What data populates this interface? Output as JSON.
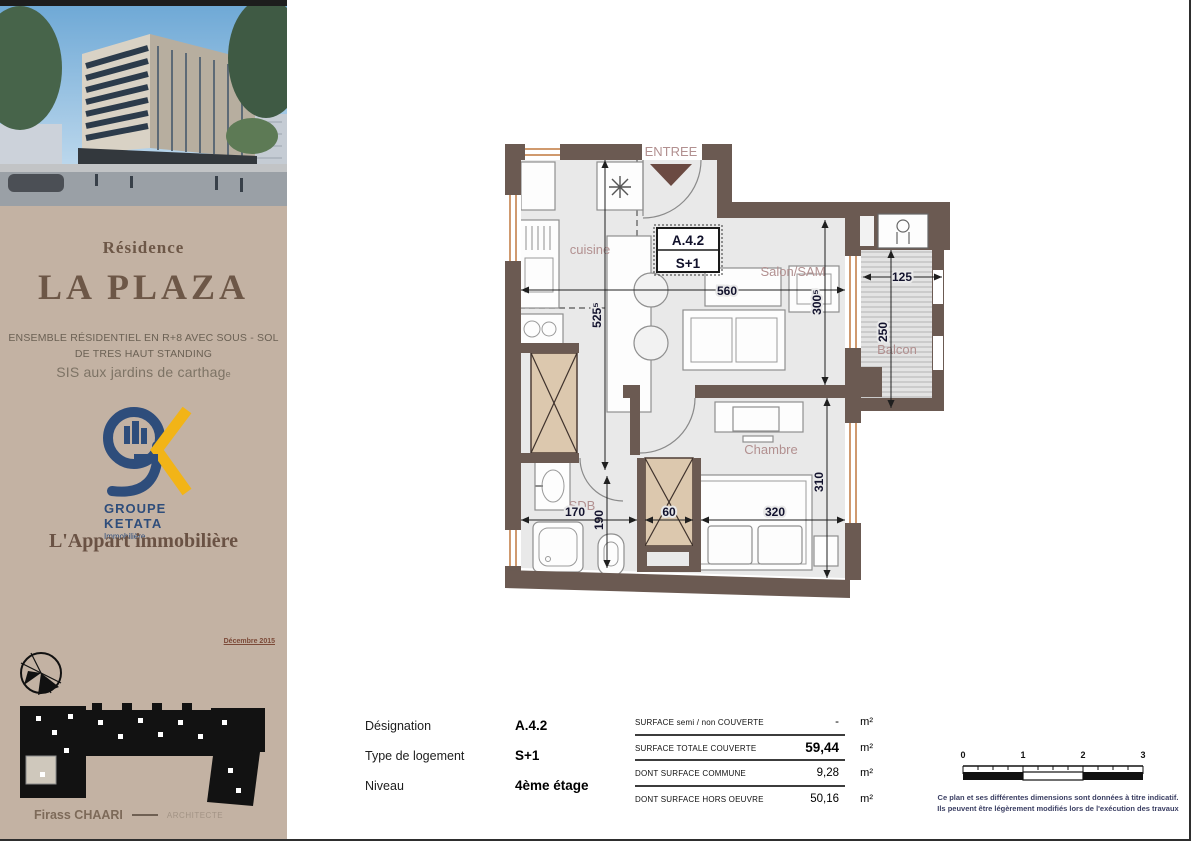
{
  "sidebar": {
    "residence_label": "Résidence",
    "title": "LA PLAZA",
    "subtitle_line1": "ENSEMBLE  RÉSIDENTIEL EN R+8 AVEC SOUS - SOL",
    "subtitle_line2": "DE TRES HAUT STANDING",
    "subtitle_line3a": "SIS aux jardins de carthag",
    "subtitle_line3b": "e",
    "logo": {
      "group_line1": "GROUPE",
      "group_line2": "KETATA",
      "group_line3": "Immobilière",
      "blue": "#2e4d7b",
      "yellow": "#f2b417"
    },
    "agency": "L'Appart immobilière",
    "date": "Décembre 2015",
    "architect_name": "Firass CHAARI",
    "architect_title": "ARCHITECTE"
  },
  "plan": {
    "entry_label": "ENTREE",
    "unit_code": "A.4.2",
    "unit_type": "S+1",
    "rooms": {
      "cuisine": "cuisine",
      "salon": "Salon/SAM",
      "chambre": "Chambre",
      "sdb": "SDB",
      "balcon": "Balcon"
    },
    "dims": {
      "top": "560",
      "kitchen_h": "525⁵",
      "salon_h": "300⁵",
      "chambre_h": "310",
      "balcon_w": "125",
      "balcon_h": "250",
      "sdb_w": "170",
      "hall_h": "190",
      "closet_w": "60",
      "chambre_w": "320"
    },
    "colors": {
      "wall": "#6b5a52",
      "room_fill": "#e9e9e9",
      "label_rose": "#b29090",
      "hatch_tan": "#dcc8ae",
      "window_orange": "#c0783f"
    }
  },
  "info": {
    "rows": [
      {
        "label": "Désignation",
        "value": "A.4.2"
      },
      {
        "label": "Type de logement",
        "value": "S+1"
      },
      {
        "label": "Niveau",
        "value": "4ème étage"
      }
    ]
  },
  "surfaces": {
    "rows": [
      {
        "label": "SURFACE semi / non COUVERTE",
        "value": "-",
        "unit": "m²"
      },
      {
        "label": "SURFACE TOTALE COUVERTE",
        "value": "59,44",
        "unit": "m²"
      },
      {
        "label": "DONT SURFACE COMMUNE",
        "value": "9,28",
        "unit": "m²"
      },
      {
        "label": "DONT SURFACE  HORS OEUVRE",
        "value": "50,16",
        "unit": "m²"
      }
    ]
  },
  "scalebar": {
    "ticks": [
      "0",
      "1",
      "2",
      "3"
    ],
    "note_line1": "Ce plan et ses différentes dimensions sont données à titre indicatif.",
    "note_line2": "Ils peuvent être légèrement modifiés lors de l'exécution des travaux"
  }
}
